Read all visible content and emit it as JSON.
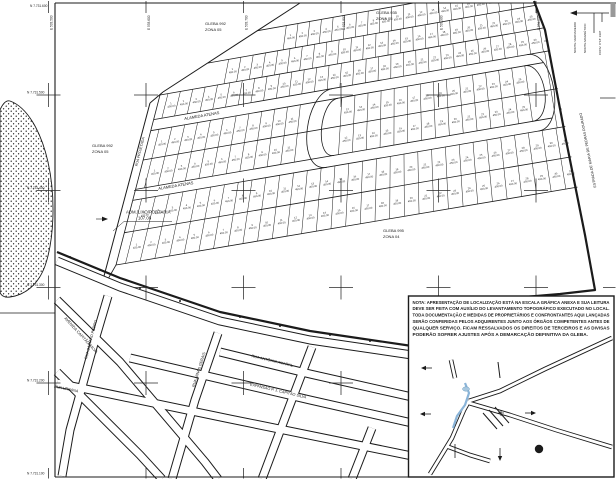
{
  "meta": {
    "drawing_type": "planta de loteamento / cadastro urbano",
    "background": "#ffffff",
    "ink": "#1b1b1b",
    "water_blue": "#8ab4d8",
    "corner_strip_gray": "#999999"
  },
  "glebas": {
    "top_left": {
      "line1": "GLEBA 992",
      "line2": "ZONA 05"
    },
    "top_center": {
      "line1": "GLEBA 935",
      "line2": "ZONA 05"
    },
    "mid_left": {
      "line1": "GLEBA 992",
      "line2": "ZONA 05"
    },
    "center": {
      "line1": "GLEBA 995",
      "line2": "ZONA 04"
    }
  },
  "subdivision": {
    "street_a": "ALAMEDA ATENAS",
    "street_b": "ALAMEDA ATENAS",
    "west_street": "RUA PROJETADA",
    "lot_area_label": "450.00",
    "rows": 7,
    "approx_lots_per_row": 30
  },
  "admin": {
    "label": "ADM./LIXO/PORTARIA",
    "area": "107.08"
  },
  "streets": {
    "avenida": "AVENIDA CAPITÃO SILVA",
    "capitao_pedro": "RUA CAPITÃO PEDRO",
    "minas_gerais": "RUA MINAS GERAIS",
    "antonio_amaral": "RUA ANTÔNIO AMARAL",
    "expansao": "EXPANSÃO P. J. CAPITÃO SILVA",
    "urbana": "RUA URBANA",
    "estrada": "ESTRADA DE MARIA DE PEDRAS DOURADO"
  },
  "grid": {
    "top_labels": [
      "E 533.500",
      "E 533.600",
      "E 533.700",
      "E 533.800",
      "E 533.900",
      "E 534.000"
    ],
    "left_labels": [
      "N 7.731.500",
      "N 7.731.400",
      "N 7.731.300",
      "N 7.731.200"
    ],
    "corner_label": "N 7.731.600",
    "bottom_label": "N 7.731.100"
  },
  "north_arrow": {
    "labels": [
      "NORTE VERDADEIRO",
      "NORTE MAGNÉTICO",
      "CONV. 0°18' 1997"
    ]
  },
  "inset": {
    "note_lines": [
      "NOTA: APRESENTAÇÃO DE LOCALIZAÇÃO ESTÁ NA ESCALA GRÁFICA ANEXA E SUA LEITURA",
      "DEVE SER FEITA COM AUXÍLIO DO LEVANTAMENTO TOPOGRÁFICO EXECUTADO NO LOCAL.",
      "TODA DOCUMENTAÇÃO E MEDIDAS DE PROPRIETÁRIOS E CONFRONTANTES AQUI LANÇADAS",
      "SERÃO CONFERIDAS PELOS ADQUIRENTES JUNTO AOS ÓRGÃOS COMPETENTES ANTES DE",
      "QUALQUER SERVIÇO. FICAM RESSALVADOS OS DIREITOS DE TERCEIROS E AS DIVISAS",
      "PODERÃO SOFRER AJUSTES APÓS A DEMARCAÇÃO DEFINITIVA DA GLEBA."
    ]
  }
}
